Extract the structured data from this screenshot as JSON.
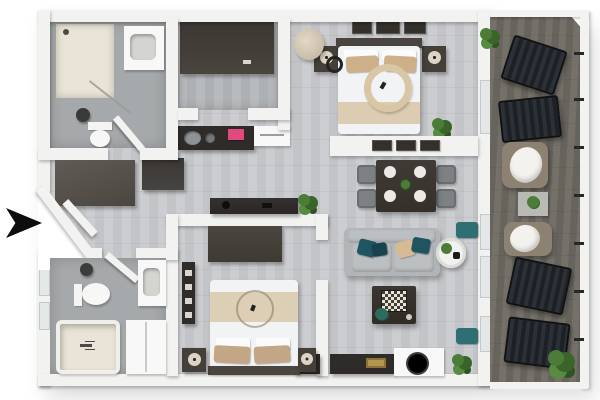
{
  "scene": {
    "type": "3d-floor-plan-render",
    "view": "top-down-isometric",
    "background": "#ffffff",
    "entrance": {
      "marker": "arrow-icon",
      "direction": "right",
      "position": "left-middle"
    }
  },
  "palette": {
    "wall": "#f2f2f0",
    "floorA": "#cccdd0",
    "floorB": "#c2c4c7",
    "bathFloor": "#a6a9ab",
    "showerBeige": "#e9e4d5",
    "deckA": "#757068",
    "deckB": "#67645e",
    "darkWood": "#453f3a",
    "charcoal": "#2e2b28",
    "sofaGray": "#b2b5b7",
    "teal": "#1f5463",
    "beige": "#cdb08a",
    "linen": "#f2f3f5",
    "plantGreen": "#4c7c38",
    "plantDark": "#3a642a",
    "pink": "#e2497e",
    "gold": "#b59552",
    "white": "#f8f8f8",
    "taupe": "#8d8172",
    "loungerDark": "#1d2024"
  },
  "rooms": [
    {
      "id": "bathroom-1",
      "label": "Bathroom 1",
      "furniture": [
        "shower",
        "vanity-sink",
        "toilet",
        "waste-bin",
        "door"
      ]
    },
    {
      "id": "walk-in-closet",
      "label": "Walk-in closet",
      "furniture": [
        "wardrobe"
      ]
    },
    {
      "id": "kitchen",
      "label": "Kitchen",
      "furniture": [
        "counter-with-sink",
        "pink-cooktop",
        "cabinet",
        "tall-cabinet"
      ]
    },
    {
      "id": "master-bedroom",
      "label": "Master bedroom",
      "furniture": [
        "double-bed",
        "nightstand-left",
        "nightstand-right",
        "wall-art",
        "round-chair",
        "floor-lamp",
        "plant"
      ]
    },
    {
      "id": "dining-area",
      "label": "Dining area",
      "furniture": [
        "dining-table",
        "four-chairs",
        "plates",
        "wall-art"
      ]
    },
    {
      "id": "living-room",
      "label": "Living room",
      "furniture": [
        "sofa",
        "coffee-table-chessboard",
        "round-side-table",
        "tv-sideboards",
        "window-benches",
        "plant",
        "column"
      ]
    },
    {
      "id": "bedroom-2",
      "label": "Bedroom 2",
      "furniture": [
        "double-bed",
        "wardrobe",
        "wall-shelf",
        "nightstand-left",
        "nightstand-right"
      ]
    },
    {
      "id": "bathroom-2",
      "label": "Bathroom 2",
      "furniture": [
        "bathtub",
        "toilet",
        "vanity-sink",
        "cabinet",
        "waste-bin",
        "door"
      ]
    },
    {
      "id": "entry-hall",
      "label": "Entry",
      "furniture": [
        "entry-wardrobe",
        "open-door",
        "entrance-arrow"
      ]
    },
    {
      "id": "balcony",
      "label": "Balcony",
      "furniture": [
        "lounger",
        "lounger",
        "armchair",
        "side-table",
        "armchair",
        "lounger",
        "lounger",
        "plants",
        "railing"
      ]
    }
  ]
}
